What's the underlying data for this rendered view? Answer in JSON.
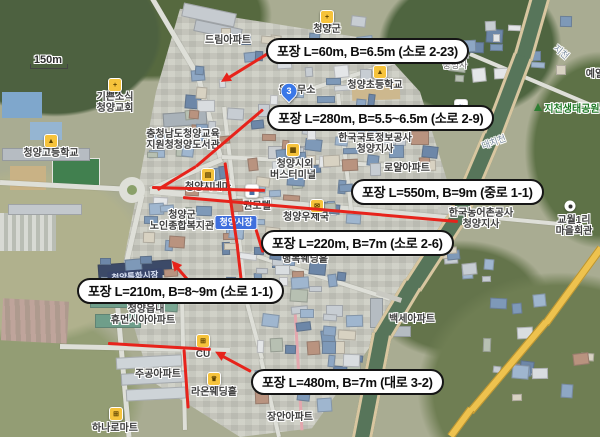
{
  "map_title": "청양읍 포장공사 위치도",
  "scale": {
    "label": "150m"
  },
  "annotations": [
    {
      "text": "포장 L=60m, B=6.5m (소로 2-23)"
    },
    {
      "text": "포장 L=280m, B=5.5~6.5m (소로 2-9)"
    },
    {
      "text": "포장 L=550m, B=9m (중로 1-1)"
    },
    {
      "text": "포장 L=220m, B=7m (소로 2-6)"
    },
    {
      "text": "포장 L=210m, B=8~9m (소로 1-1)"
    },
    {
      "text": "포장 L=480m, B=7m (대로 3-2)"
    }
  ],
  "labels": {
    "dream_apt": "드림아파트",
    "cheongyang_gun": "청양군",
    "church_line1": "기쁜소식",
    "church_line2": "청양교회",
    "edu_line1": "충청남도청양교육",
    "edu_line2": "지원청청양도서관",
    "high_school": "청양고등학교",
    "elem_school": "청양초등학교",
    "chungnyeongsa": "충령사",
    "jicheon": "지천",
    "yeil": "예일",
    "eco_park": "지천생태공원",
    "eup_office": "읍사무소",
    "route_badge": "3",
    "lx_line1": "한국국토정보공사",
    "lx_line2": "청양지사",
    "bus_line1": "청양시외",
    "bus_line2": "버스터미널",
    "royal_apt": "로얄아파트",
    "cinema": "청양시네마",
    "kwon_motel": "권모텔",
    "welfare_line1": "청양군",
    "welfare_line2": "노인종합복지관",
    "market_chip": "청양시장",
    "special_market": "청양특화시장",
    "post_office": "청양우체국",
    "happy_wedding": "행복웨딩홀",
    "krc_line1": "한국농어촌공사",
    "krc_line2": "청양지사",
    "gyowol_line1": "교월1리",
    "gyowol_line2": "마을회관",
    "daechicheon": "대치천",
    "humansia_line1": "청양읍내",
    "humansia_line2": "휴먼시아아파트",
    "jugong_apt": "주공아파트",
    "cu_store": "CU",
    "raon_wedding": "라온웨딩홀",
    "hanaro_mart": "하나로마트",
    "jangan_apt": "장안아파트",
    "baekse_apt": "백세아파트"
  },
  "icons": {
    "school": "▲",
    "medical": "+",
    "post": "✉",
    "bus": "▦",
    "cart": "⊞",
    "wedding": "♛",
    "cinema": "▤",
    "motel": "▄",
    "bath": "≈",
    "church": "+"
  },
  "colors": {
    "overlay_red": "#e7231b",
    "annotation_border": "#151515",
    "market_chip_blue": "#3f6fdd",
    "river_green": "#57755a",
    "highway_yellow": "#eec24e"
  }
}
